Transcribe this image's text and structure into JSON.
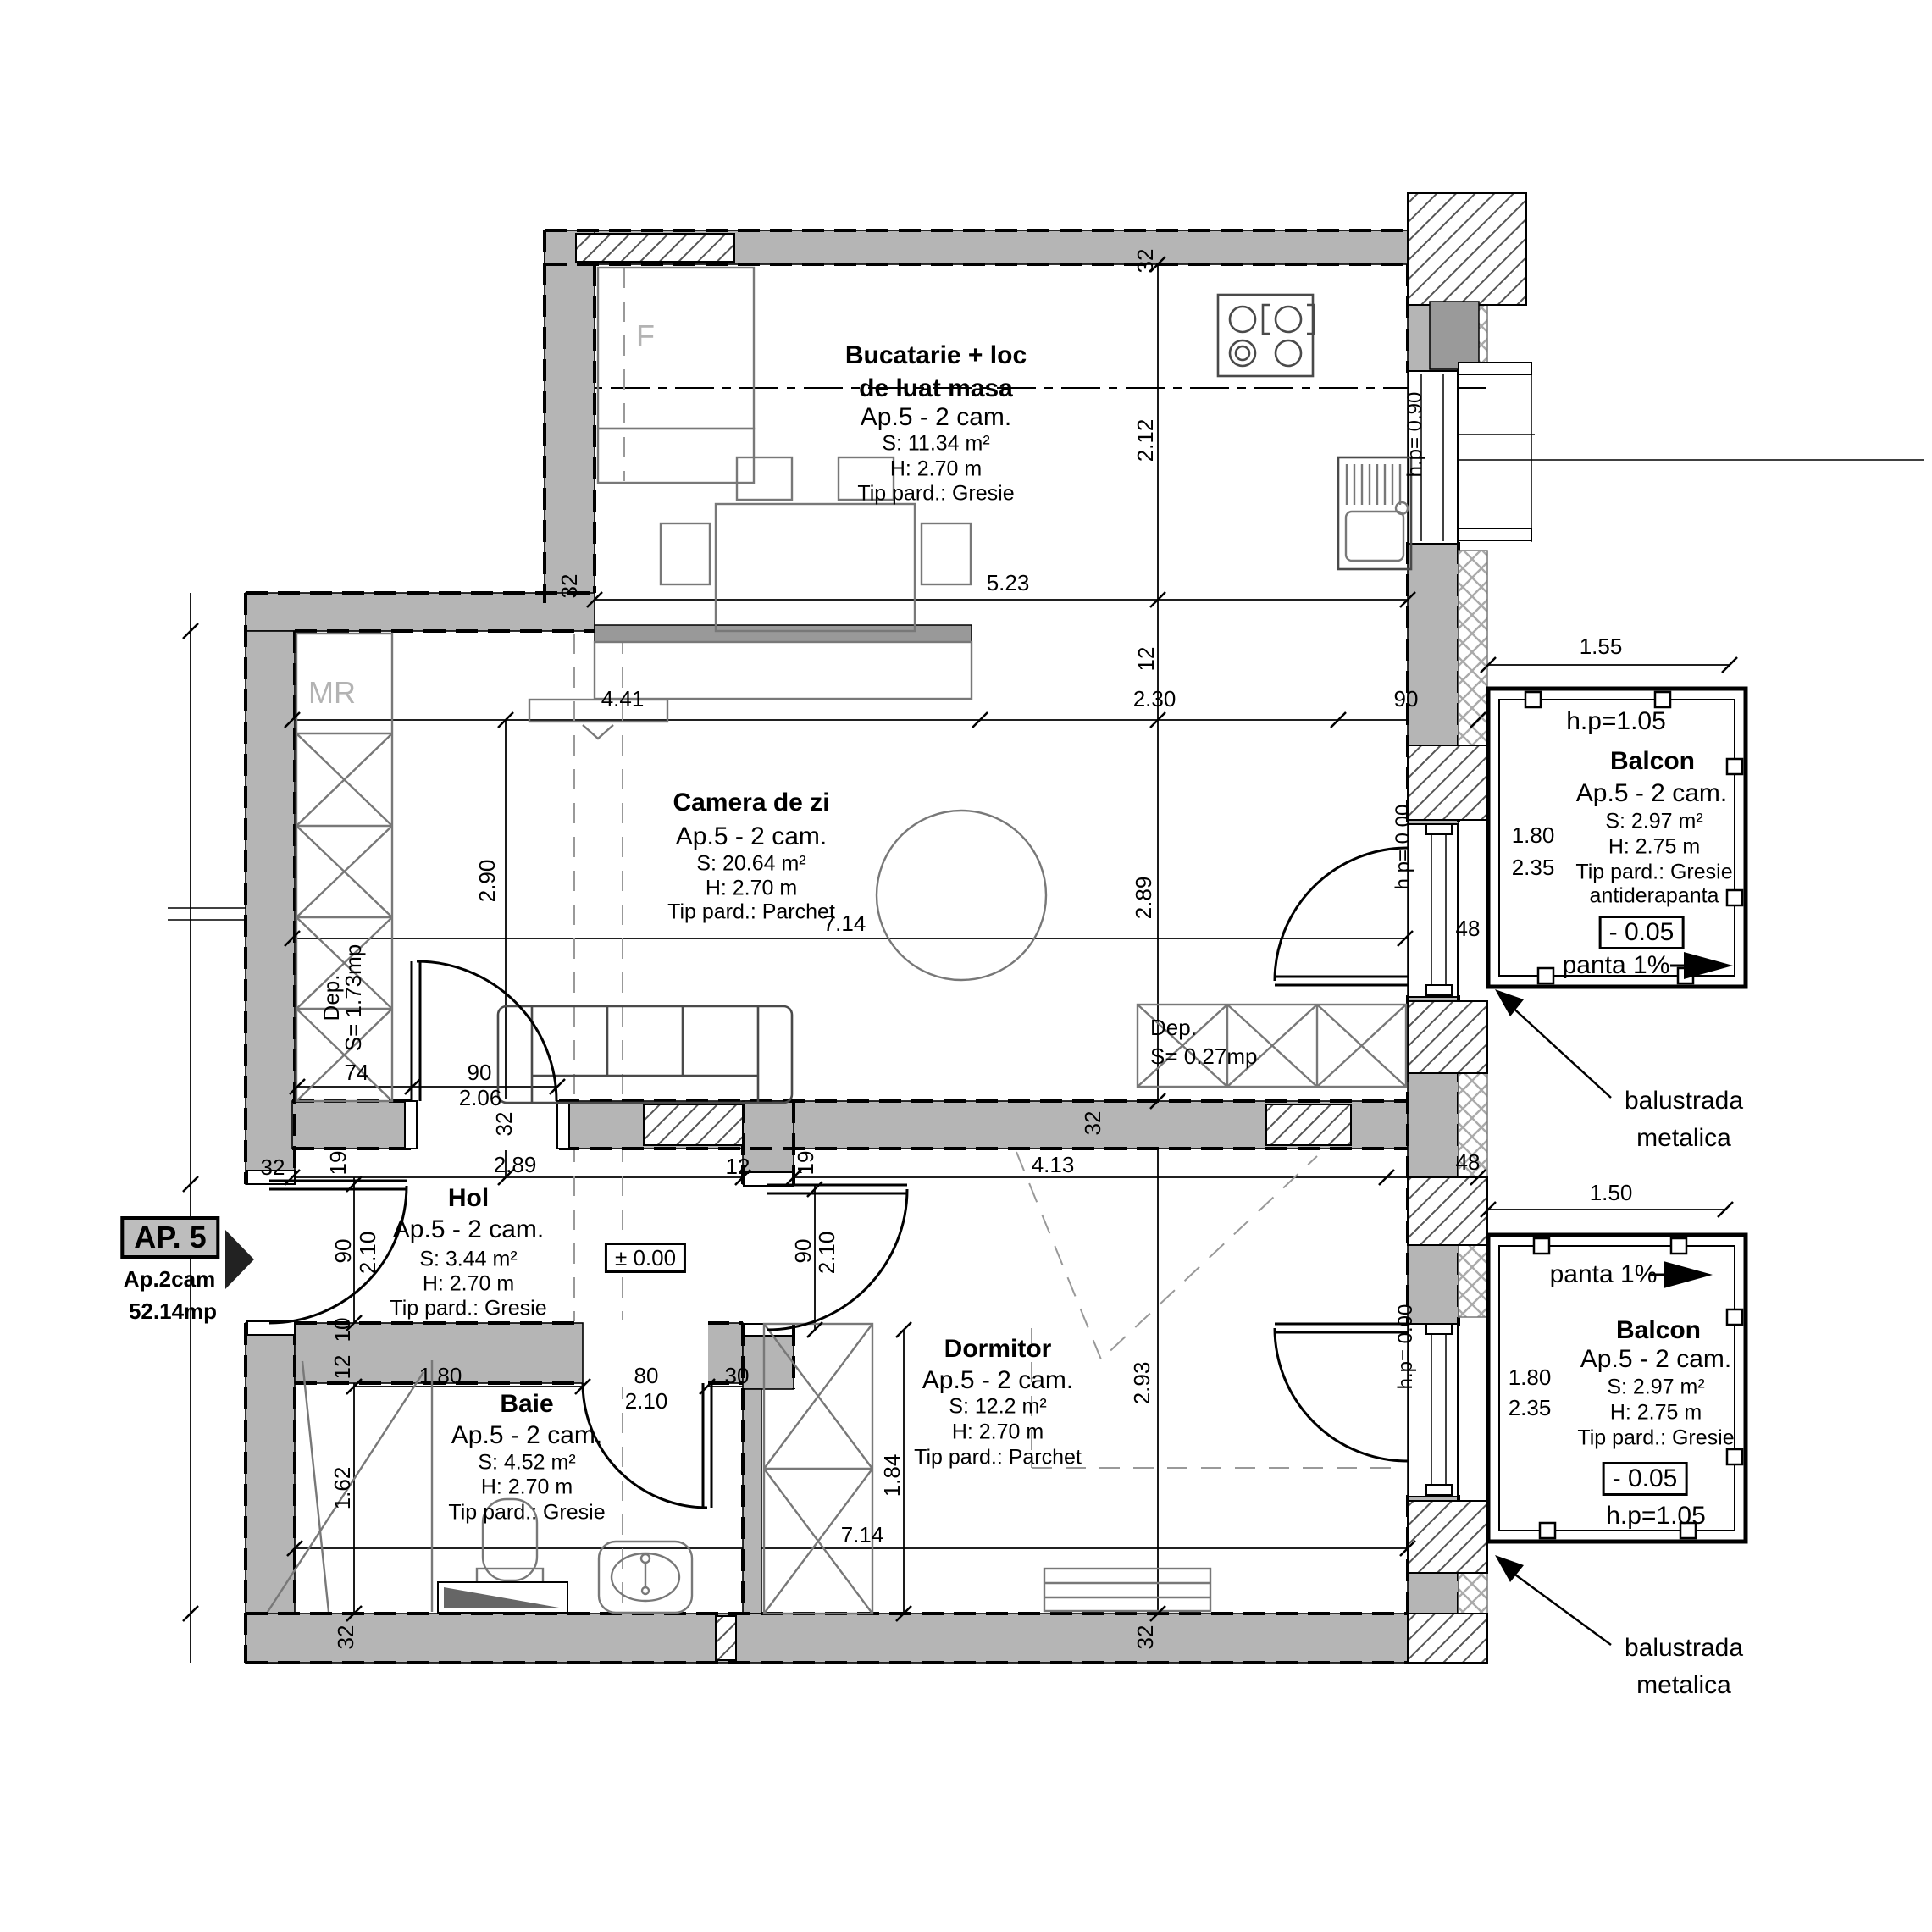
{
  "colors": {
    "wall_fill": "#b5b5b5",
    "muted_label": "#b3b3b3",
    "line": "#000000"
  },
  "marker": {
    "id": "AP. 5",
    "type": "Ap.2cam",
    "area": "52.14mp"
  },
  "rooms": {
    "bucatarie": {
      "t1": "Bucatarie + loc",
      "t2": "de luat masa",
      "apt": "Ap.5 - 2 cam.",
      "s": "S: 11.34 m²",
      "h": "H: 2.70 m",
      "p": "Tip pard.: Gresie"
    },
    "camera": {
      "t": "Camera de zi",
      "apt": "Ap.5 - 2 cam.",
      "s": "S: 20.64 m²",
      "h": "H: 2.70 m",
      "p": "Tip pard.: Parchet"
    },
    "hol": {
      "t": "Hol",
      "apt": "Ap.5 - 2 cam.",
      "s": "S: 3.44 m²",
      "h": "H: 2.70 m",
      "p": "Tip pard.: Gresie",
      "level": "± 0.00"
    },
    "baie": {
      "t": "Baie",
      "apt": "Ap.5 - 2 cam.",
      "s": "S: 4.52 m²",
      "h": "H: 2.70 m",
      "p": "Tip pard.: Gresie"
    },
    "dormitor": {
      "t": "Dormitor",
      "apt": "Ap.5 - 2 cam.",
      "s": "S: 12.2 m²",
      "h": "H: 2.70 m",
      "p": "Tip pard.: Parchet"
    },
    "balcon1": {
      "hp": "h.p=1.05",
      "t": "Balcon",
      "apt": "Ap.5 - 2 cam.",
      "s": "S: 2.97 m²",
      "h": "H: 2.75 m",
      "p": "Tip pard.: Gresie",
      "p2": "antiderapanta",
      "level": "- 0.05",
      "panta": "panta 1%"
    },
    "balcon2": {
      "panta": "panta 1%",
      "t": "Balcon",
      "apt": "Ap.5 - 2 cam.",
      "s": "S: 2.97 m²",
      "h": "H: 2.75 m",
      "p": "Tip pard.: Gresie",
      "level": "- 0.05",
      "hp": "h.p=1.05"
    }
  },
  "storage": {
    "dep1_l1": "Dep.",
    "dep1_l2": "S= 1.73mp",
    "dep2_l1": "Dep.",
    "dep2_l2": "S= 0.27mp"
  },
  "notes": {
    "balustrada_l1": "balustrada",
    "balustrada_l2": "metalica",
    "mr": "MR",
    "f": "F",
    "hp090": "h.p= 0.90",
    "hp000": "h.p= 0.00"
  },
  "dims": {
    "d523": "5.23",
    "d212": "2.12",
    "d441": "4.41",
    "d230": "2.30",
    "d290": "2.90",
    "d289": "2.89",
    "d293": "2.93",
    "d206": "2.06",
    "d210": "2.10",
    "d413": "4.13",
    "d714": "7.14",
    "d150": "1.50",
    "d155": "1.55",
    "d162": "1.62",
    "d180": "1.80",
    "d184": "1.84",
    "d235": "2.35",
    "d32": "32",
    "d19": "19",
    "d12": "12",
    "d10": "10",
    "d90": "90",
    "d74": "74",
    "d80": "80",
    "d30": "30",
    "d48": "48"
  }
}
